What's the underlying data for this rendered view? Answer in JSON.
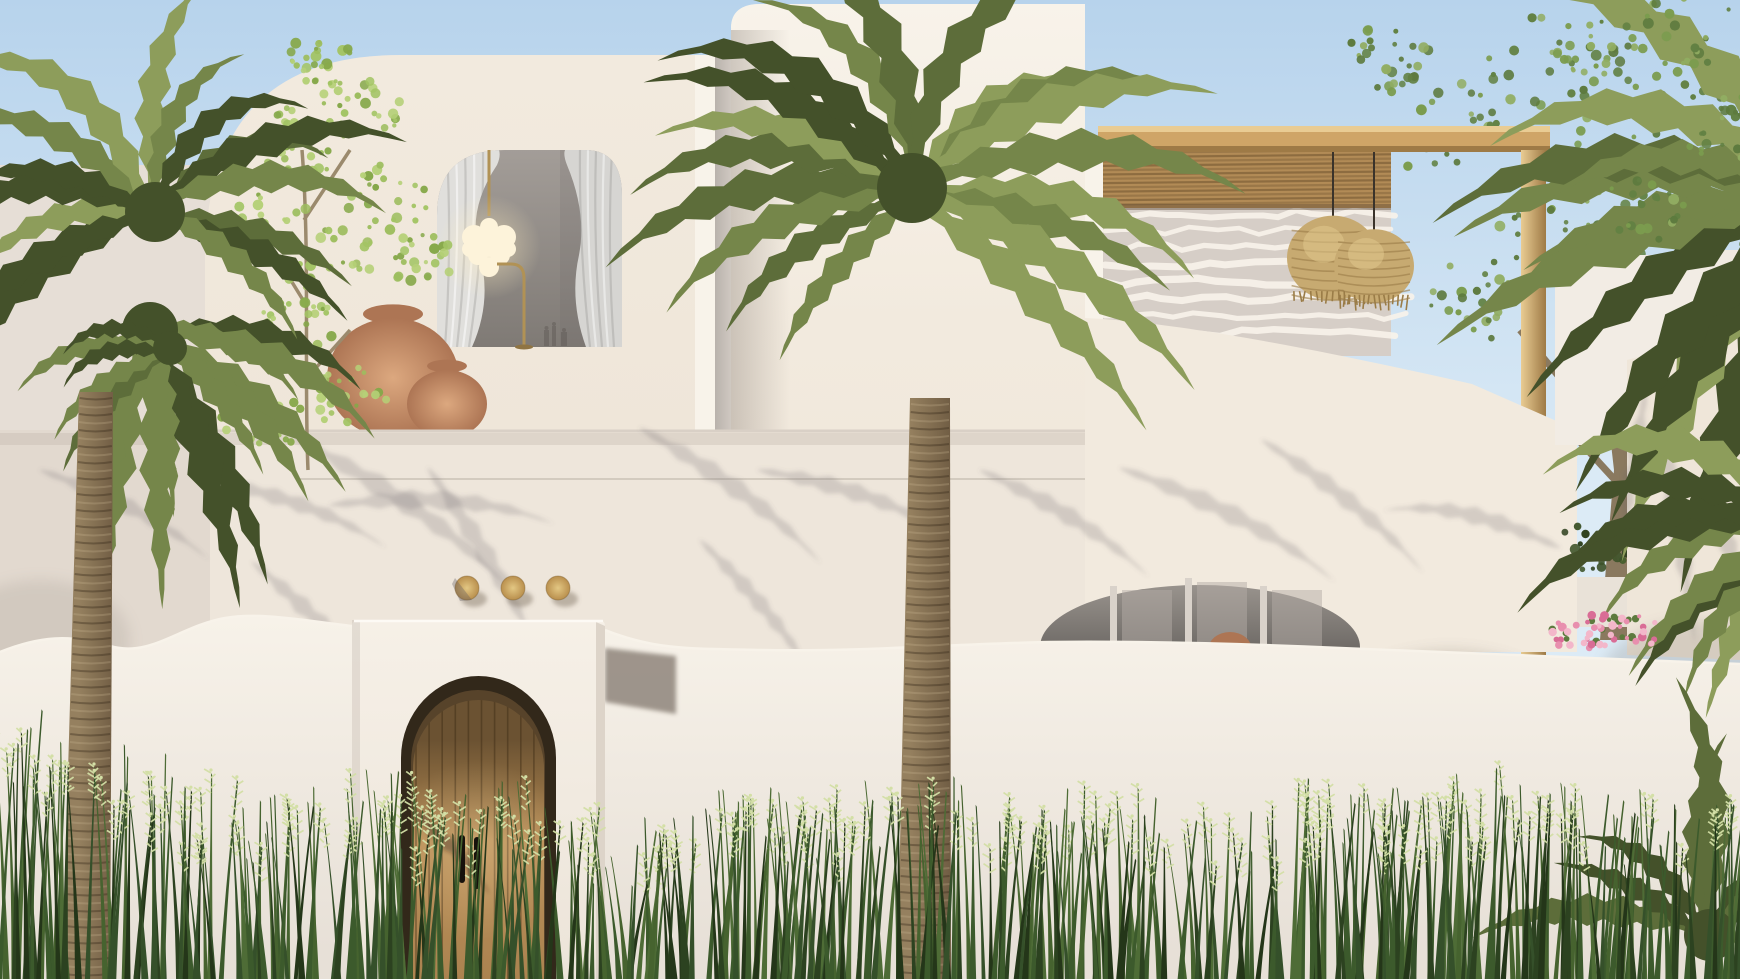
{
  "scene": {
    "type": "architectural-exterior-render",
    "subject": "white-mediterranean-villa",
    "time_of_day": "day"
  },
  "palette": {
    "sky_top": "#b7d3ec",
    "sky_horizon": "#dcebf6",
    "wall_sunlit": "#f2eade",
    "wall_bright": "#f8f3ea",
    "wall_warm": "#efe6d9",
    "wall_mid": "#eee6db",
    "wall_shaded": "#dcd4cc",
    "wall_deep": "#b9b2ac",
    "interior_top": "#a39d98",
    "interior_bottom": "#7f7a75",
    "curtain_light": "#e0dfdc",
    "curtain_mid": "#cfcecb",
    "brass": "#b19255",
    "glow": "#ffeec0",
    "bulb": "#fdf3da",
    "gold_disc_hi": "#e3c783",
    "gold_disc_lo": "#b98f4d",
    "door_wood": "#b98f58",
    "door_wood_dark": "#6b5232",
    "door_recess": "#32281a",
    "pergola_wood": "#cfa567",
    "pergola_wood_hi": "#e9cc93",
    "pergola_wood_lo": "#9e7a46",
    "slat": "#b28b56",
    "slat_dark": "#7d5f38",
    "rattan": "#c7aa71",
    "rattan_dark": "#9a7c47",
    "rattan_hi": "#e0c68d",
    "terracotta": "#d09a76",
    "terracotta_dark": "#ad7554",
    "palm_dark": "#44512a",
    "palm_mid": "#5d6d3a",
    "palm_light": "#75864a",
    "palm_hi": "#8d9d5b",
    "leaf_bright": "#9dbd5e",
    "leaf_mid": "#7b9c4e",
    "leaf_dark": "#628143",
    "trunk_light": "#95805f",
    "trunk_dark": "#6a573f",
    "grass_dark": "#2c4220",
    "grass_mid": "#3c5a2c",
    "grass_light": "#4e6c36",
    "seed": "#d3dfa6",
    "flower_pink": "#e88fae",
    "flower_deep": "#d96d96",
    "shadow": "rgba(106,99,104,0.22)",
    "blotch": "rgba(118,110,104,0.30)"
  },
  "counts": {
    "gold_wall_discs": 3,
    "rattan_pendant_lamps": 2,
    "chandelier_bulbs": 9,
    "terracotta_pots": 2,
    "door_handles": 2,
    "palm_trees": 3
  },
  "objects": [
    {
      "name": "sky",
      "label": "clear blue sky"
    },
    {
      "name": "left-volume",
      "label": "white volume with rounded corner and curtained window"
    },
    {
      "name": "grape-chandelier",
      "label": "glass bubble chandelier on brass stem"
    },
    {
      "name": "floor-lamp",
      "label": "brass arc floor lamp"
    },
    {
      "name": "terracotta-pots",
      "label": "terracotta pots on balcony ledge"
    },
    {
      "name": "tall-volume",
      "label": "tall white block volume"
    },
    {
      "name": "pergola",
      "label": "timber pergola with reed slat roof"
    },
    {
      "name": "rattan-pendant-lamps",
      "label": "two rattan pendant lamps"
    },
    {
      "name": "swoosh-wall",
      "label": "white wall with sloping parapet and shallow arch"
    },
    {
      "name": "gold-wall-discs",
      "label": "three brass discs on wall"
    },
    {
      "name": "entry-portal",
      "label": "white entry portal"
    },
    {
      "name": "arched-entry-door",
      "label": "arched timber plank door with two black pull handles"
    },
    {
      "name": "left-palm-tree",
      "label": "date palm"
    },
    {
      "name": "center-palm-tree",
      "label": "date palm"
    },
    {
      "name": "right-foliage",
      "label": "palms and leafy trees"
    },
    {
      "name": "bougainvillea-flowers",
      "label": "pink bougainvillea over wall"
    },
    {
      "name": "foreground-grass",
      "label": "tall meadow grass with seed heads"
    }
  ]
}
